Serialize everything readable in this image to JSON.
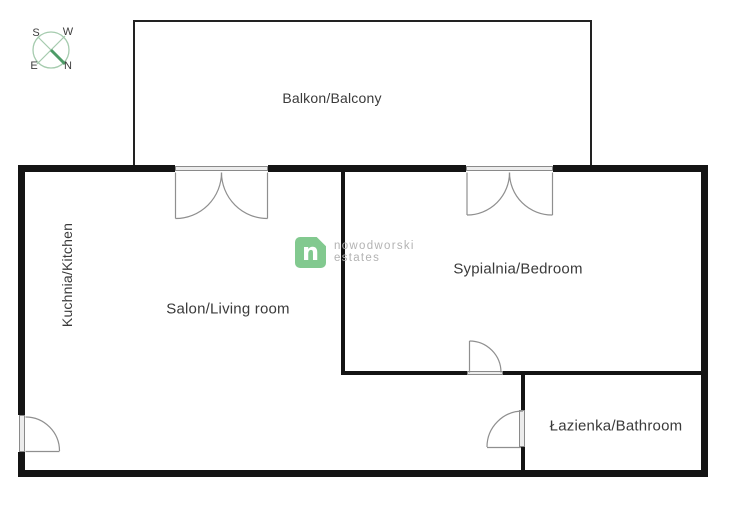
{
  "compass": {
    "s": "S",
    "w": "W",
    "e": "E",
    "n": "N"
  },
  "watermark": {
    "glyph": "n",
    "line1": "nowodworski",
    "line2": "estates"
  },
  "rooms": {
    "balcony": {
      "label": "Balkon/Balcony"
    },
    "kitchen": {
      "label": "Kuchnia/Kitchen"
    },
    "living_room": {
      "label": "Salon/Living room"
    },
    "bedroom": {
      "label": "Sypialnia/Bedroom"
    },
    "bathroom": {
      "label": "Łazienka/Bathroom"
    }
  },
  "colors": {
    "wall": "#141414",
    "door_stroke": "#8f8f8f",
    "compass_green": "#a5cbae",
    "compass_needle": "#4d9b67",
    "logo_green": "#82c98f",
    "watermark_text": "#b3b3b3",
    "label_text": "#3a3a3a"
  }
}
